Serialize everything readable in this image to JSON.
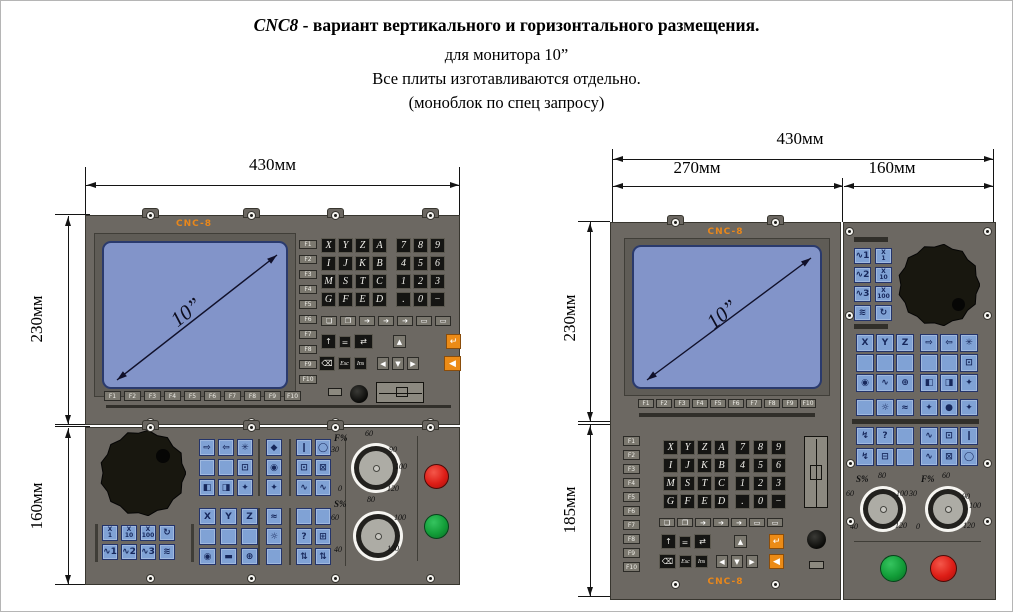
{
  "title": {
    "line1_em": "CNC8",
    "line1_rest": " - вариант вертикального и горизонтального  размещения.",
    "line2": "для монитора 10”",
    "line3": "Все плиты изготавливаются отдельно.",
    "line4": "(моноблок по спец запросу)"
  },
  "brand": "CNC-8",
  "screen": {
    "size_label": "10”"
  },
  "dims": {
    "w430": "430мм",
    "w270": "270мм",
    "w160": "160мм",
    "h230": "230мм",
    "h160": "160мм",
    "h185": "185мм"
  },
  "keys": {
    "fkeys": [
      "F1",
      "F2",
      "F3",
      "F4",
      "F5",
      "F6",
      "F7",
      "F8",
      "F9",
      "F10"
    ],
    "letters": [
      "X",
      "Y",
      "Z",
      "A",
      "I",
      "J",
      "K",
      "B",
      "M",
      "S",
      "T",
      "C",
      "G",
      "F",
      "E",
      "D"
    ],
    "numpad": [
      "7",
      "8",
      "9",
      "4",
      "5",
      "6",
      "1",
      "2",
      "3",
      ".",
      "0",
      "−"
    ],
    "edit_row": [
      "❏",
      "❐",
      "➔",
      "➔",
      "➔",
      "▭",
      "▭"
    ],
    "nav_row1": [
      "↑",
      "=",
      "⇄"
    ],
    "nav_up": "▲",
    "nav_row2": [
      "⌫",
      "Esc",
      "Ins"
    ],
    "nav_arrows": [
      "◀",
      "▼",
      "▶"
    ],
    "orange_top": "↵",
    "orange_bottom": "◀",
    "wheel_grid": [
      "X\n1",
      "X\n10",
      "X\n100",
      "↻",
      "∿1",
      "∿2",
      "∿3",
      "≋"
    ],
    "side_wheel": [
      "∿1",
      "X\n1",
      "∿2",
      "X\n10",
      "∿3",
      "X\n100",
      "≋",
      "↻"
    ],
    "mfA": [
      "⇨",
      "⇦",
      "✳",
      "",
      "",
      "⊡",
      "◧",
      "◨",
      "✦"
    ],
    "mfB": [
      "◆",
      "◉",
      "✦"
    ],
    "mfC": [
      "❙",
      "◯",
      "⊡",
      "⊠",
      "∿",
      "∿"
    ],
    "mfD": [
      "X",
      "Y",
      "Z",
      "",
      "",
      "",
      "◉",
      "▬",
      "⊕"
    ],
    "mfE": [
      "≈",
      "☼",
      ""
    ],
    "mfF": [
      "",
      "",
      "?",
      "⊞",
      "⇅",
      "⇅"
    ],
    "sideG1L": [
      "X",
      "Y",
      "Z",
      "",
      "",
      "",
      "◉",
      "∿",
      "⊕"
    ],
    "sideG1R": [
      "⇨",
      "⇦",
      "✳",
      "",
      "",
      "⊡",
      "◧",
      "◨",
      "✦"
    ],
    "sideG2L": [
      "",
      "☼",
      "≈"
    ],
    "sideG2R": [
      "✦",
      "●",
      "✦"
    ],
    "sideG3L": [
      "↯",
      "?",
      "",
      "↯",
      "⊟",
      ""
    ],
    "sideG3R": [
      "∿",
      "⊡",
      "❙",
      "∿",
      "⊠",
      "◯"
    ]
  },
  "dials": {
    "F": {
      "label": "F%",
      "top": "60",
      "left": "30",
      "right": "90",
      "right_low": "100",
      "bottom_left": "0",
      "bottom_right": "120"
    },
    "S": {
      "label": "S%",
      "top": "80",
      "left": "60",
      "right": "100",
      "bottom_left": "40",
      "bottom_right": "120"
    }
  },
  "colors": {
    "brand_orange": "#e8871b",
    "panel_gray": "#6c6862",
    "screen_blue": "#8294c9",
    "key_blue": "#80a2d5",
    "key_orange": "#ec8b16",
    "stop_red": "#dd1d16",
    "start_green": "#129d38"
  }
}
